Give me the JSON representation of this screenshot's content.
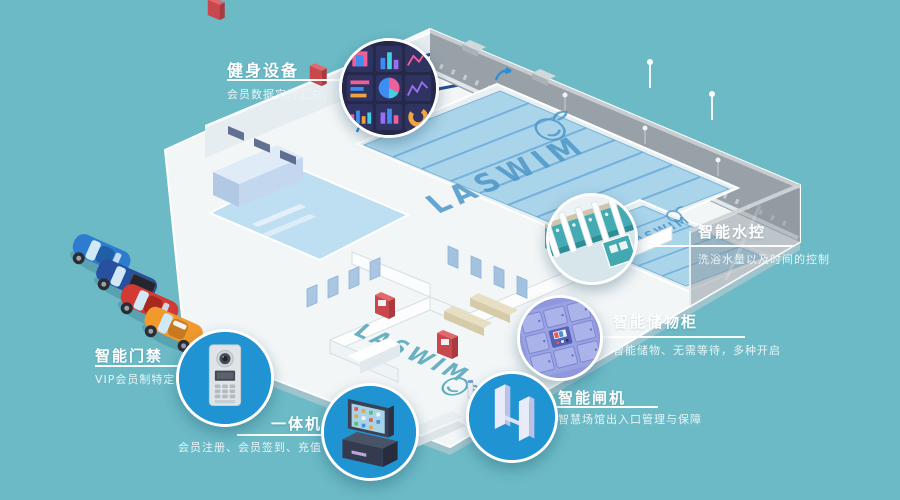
{
  "scene": {
    "background_color": "#6bbac6",
    "description": "isometric smart natatorium facility"
  },
  "branding": {
    "main_pool_logo": "LASWIM",
    "training_pool_logo": "LASWIM",
    "lobby_floor_logo": "LASWIM"
  },
  "callouts": [
    {
      "id": "fitness",
      "title": "健身设备",
      "subtitle": "会员数据实时汇总、健身可视化",
      "icon": "fitness-dashboard-icon"
    },
    {
      "id": "water",
      "title": "智能水控",
      "subtitle": "洗浴水量以及时间的控制",
      "icon": "shower-stalls-icon"
    },
    {
      "id": "locker",
      "title": "智能储物柜",
      "subtitle": "智能储物、无需等待，多种开启",
      "icon": "smart-locker-icon"
    },
    {
      "id": "gate",
      "title": "智能闸机",
      "subtitle": "智慧场馆出入口管理与保障",
      "icon": "turnstile-icon"
    },
    {
      "id": "kiosk",
      "title": "一体机",
      "subtitle": "会员注册、会员签到、充值",
      "icon": "kiosk-terminal-icon"
    },
    {
      "id": "access",
      "title": "智能门禁",
      "subtitle": "VIP会员制特定场所通行",
      "icon": "intercom-panel-icon"
    }
  ],
  "parking": {
    "cars": [
      {
        "name": "blue-sports-car",
        "color": "#2e7cd0"
      },
      {
        "name": "navy-pickup-truck",
        "color": "#27519e"
      },
      {
        "name": "red-sports-car",
        "color": "#d23a35"
      },
      {
        "name": "orange-car",
        "color": "#f09a2e"
      }
    ]
  },
  "colors": {
    "background": "#6bbac6",
    "hotspot_blue": "#1f93d2",
    "fitness_panel_navy": "#252849",
    "locker_periwinkle": "#8f98dc",
    "pool_water": "#a9d4ea",
    "lane_line": "#68a8d8",
    "building_white": "#f2f6f7",
    "back_wall_gray": "#99a1a8",
    "title_text": "#ffffff"
  }
}
